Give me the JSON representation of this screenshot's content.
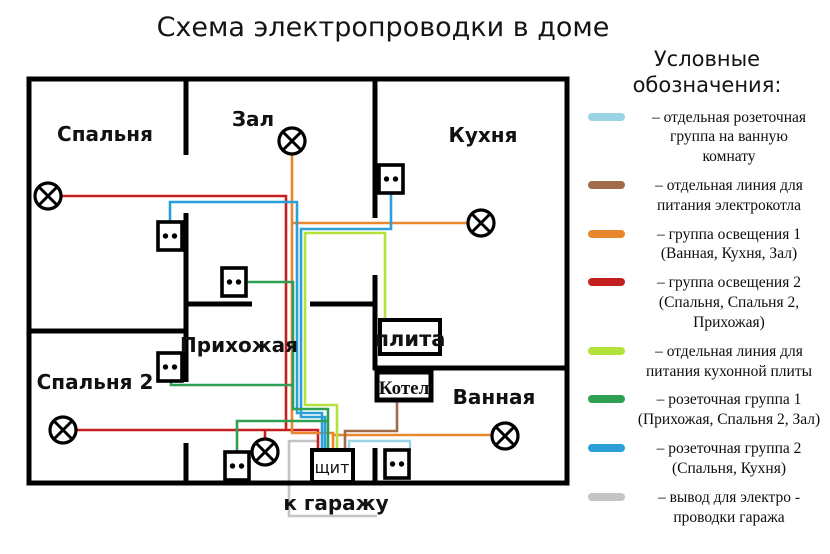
{
  "title": "Схема электропроводки в доме",
  "legend": {
    "title": "Условные обозначения:",
    "items": [
      {
        "key": "bathroom-socket-line",
        "color": "#9BD2E4",
        "text": "– отдельная розеточная\nгруппа на ванную\nкомнату"
      },
      {
        "key": "boiler-line",
        "color": "#A06C4C",
        "text": "– отдельная линия для\nпитания электрокотла"
      },
      {
        "key": "lighting-group-1",
        "color": "#E8872E",
        "text": "– группа освещения 1\n(Ванная, Кухня, Зал)"
      },
      {
        "key": "lighting-group-2",
        "color": "#C41F1F",
        "text": "– группа освещения 2\n(Спальня, Спальня 2,\nПрихожая)"
      },
      {
        "key": "stove-line",
        "color": "#B5E13B",
        "text": "– отдельная линия для\nпитания кухонной плиты"
      },
      {
        "key": "socket-group-1",
        "color": "#2FA053",
        "text": "– розеточная группа 1\n(Прихожая, Спальня 2, Зал)"
      },
      {
        "key": "socket-group-2",
        "color": "#2B9FD9",
        "text": "– розеточная группа 2\n(Спальня, Кухня)"
      },
      {
        "key": "garage-line",
        "color": "#C4C4C4",
        "text": "– вывод для электро -\nпроводки гаража"
      }
    ]
  },
  "rooms": {
    "bedroom": "Спальня",
    "hall": "Зал",
    "kitchen": "Кухня",
    "hallway": "Прихожая",
    "bedroom2": "Спальня 2",
    "bathroom": "Ванная"
  },
  "labels": {
    "stove": "плита",
    "boiler": "Котел",
    "panel": "щит",
    "garage": "к гаражу"
  }
}
